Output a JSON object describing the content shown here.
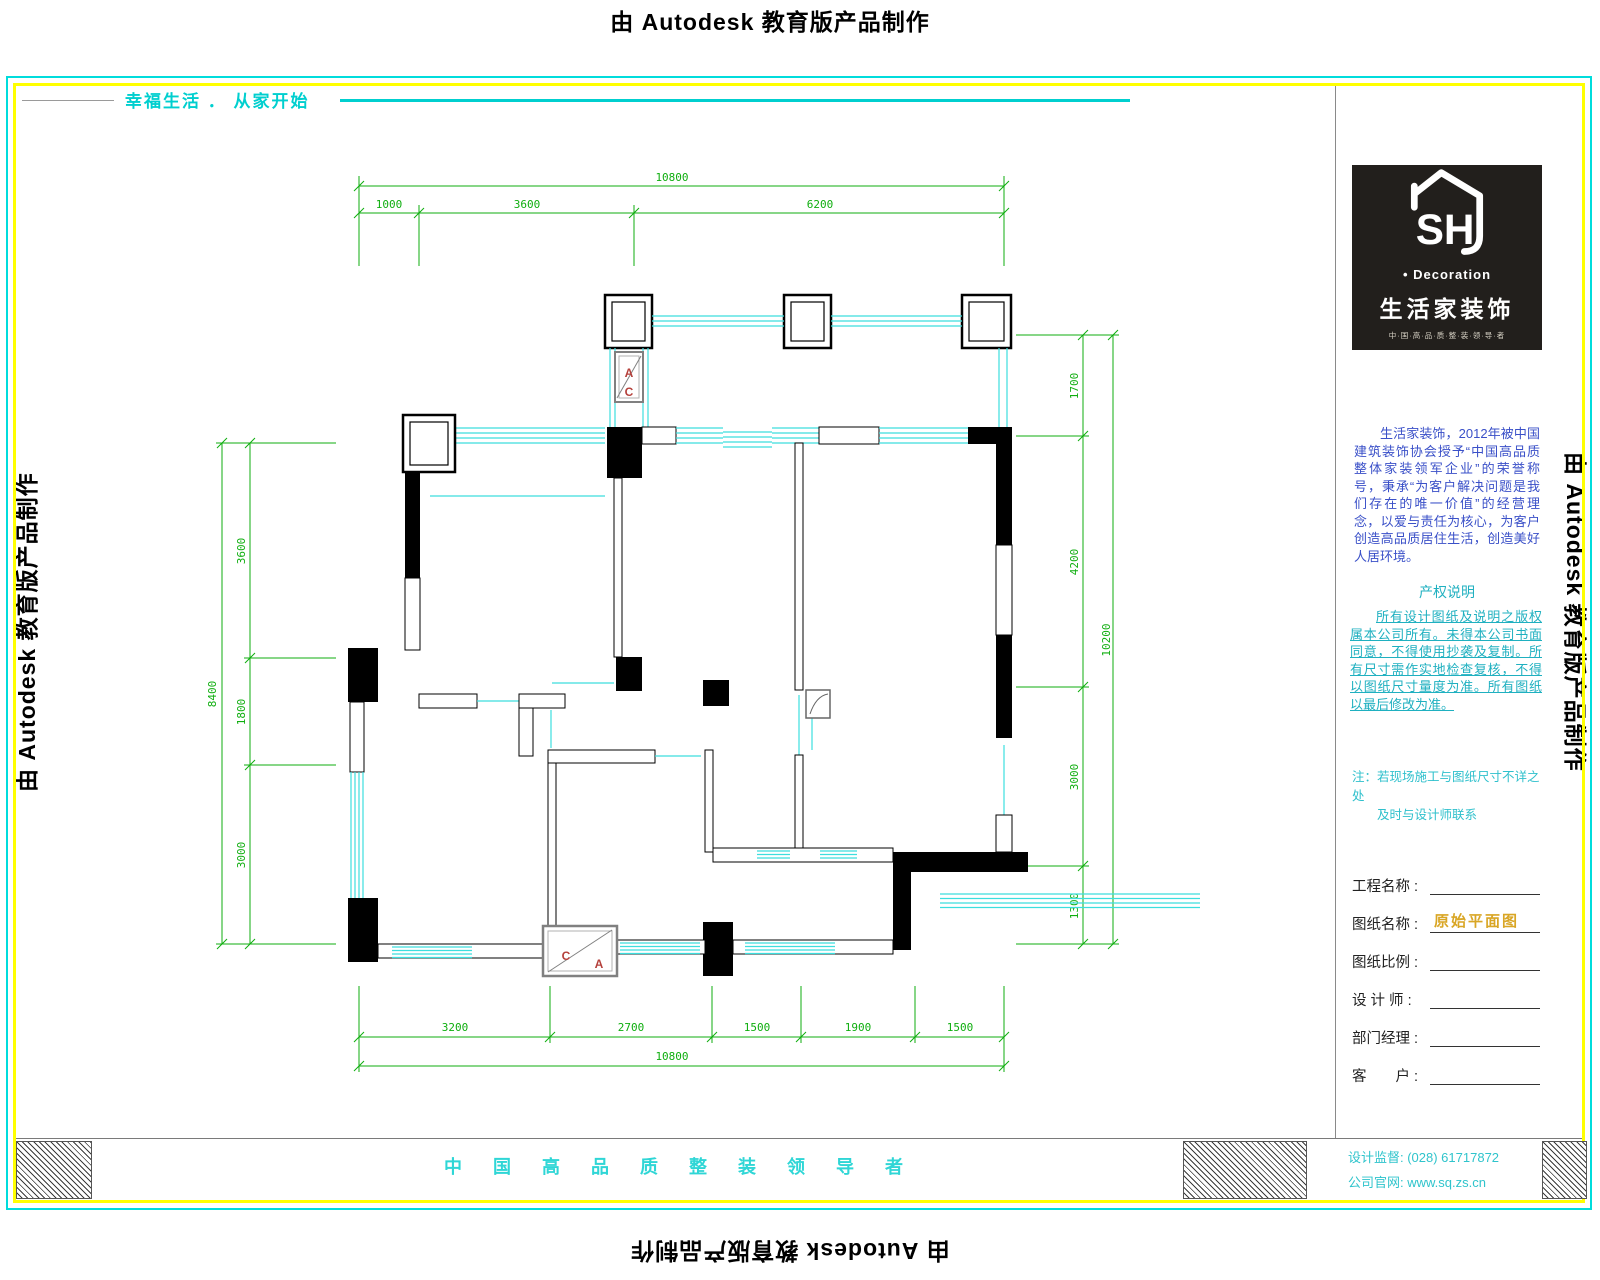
{
  "watermark": "由 Autodesk 教育版产品制作",
  "tagline": "幸福生活 ． 从家开始",
  "footer": {
    "slogan": "中 国 高 品 质 整 装 领 导 者",
    "phone_line": "设计监督: (028) 61717872",
    "website_line": "公司官网: www.sq.zs.cn"
  },
  "logo": {
    "sh": "SH",
    "decoration": "• Decoration",
    "name": "生活家装饰",
    "sub": "中·国·高·品·质·整·装·领·导·者"
  },
  "title_block": {
    "intro": "生活家装饰，2012年被中国建筑装饰协会授予“中国高品质整体家装领军企业”的荣誉称号，秉承“为客户解决问题是我们存在的唯一价值”的经营理念，以爱与责任为核心，为客户创造高品质居住生活，创造美好人居环境。",
    "rights_title": "产权说明",
    "rights_text": "所有设计图纸及说明之版权属本公司所有。未得本公司书面同意，不得使用抄袭及复制。所有尺寸需作实地检查复核，不得以图纸尺寸量度为准。所有图纸以最后修改为准。",
    "note_line1": "注：若现场施工与图纸尺寸不详之处",
    "note_line2": "及时与设计师联系",
    "fields": [
      {
        "label": "工程名称 :",
        "value": ""
      },
      {
        "label": "图纸名称 :",
        "value": "原始平面图"
      },
      {
        "label": "图纸比例 :",
        "value": ""
      },
      {
        "label": "设 计 师 :",
        "value": ""
      },
      {
        "label": "部门经理 :",
        "value": ""
      },
      {
        "label": "客　　户 :",
        "value": ""
      }
    ]
  },
  "plan": {
    "dims": {
      "top": {
        "total": "10800",
        "segments": [
          "1000",
          "3600",
          "6200"
        ]
      },
      "bottom": {
        "total": "10800",
        "segments": [
          "3200",
          "2700",
          "1500",
          "1900",
          "1500"
        ]
      },
      "left": {
        "total": "8400",
        "segments": [
          "3600",
          "1800",
          "3000"
        ]
      },
      "right": {
        "total": "10200",
        "segments": [
          "1700",
          "4200",
          "3000",
          "1300"
        ]
      }
    },
    "ac_top": [
      "A",
      "C"
    ],
    "ac_bottom": [
      "C",
      "A"
    ],
    "colors": {
      "window_cyan": "#3cdede",
      "dimension_green": "#0fae0f",
      "border_yellow": "#ffff00",
      "border_cyan": "#00dcdc",
      "ac_red": "#b5413c",
      "intro_blue": "#3a50c8",
      "rights_teal": "#1fb0c0",
      "drawing_name_gold": "#d9a625"
    }
  }
}
